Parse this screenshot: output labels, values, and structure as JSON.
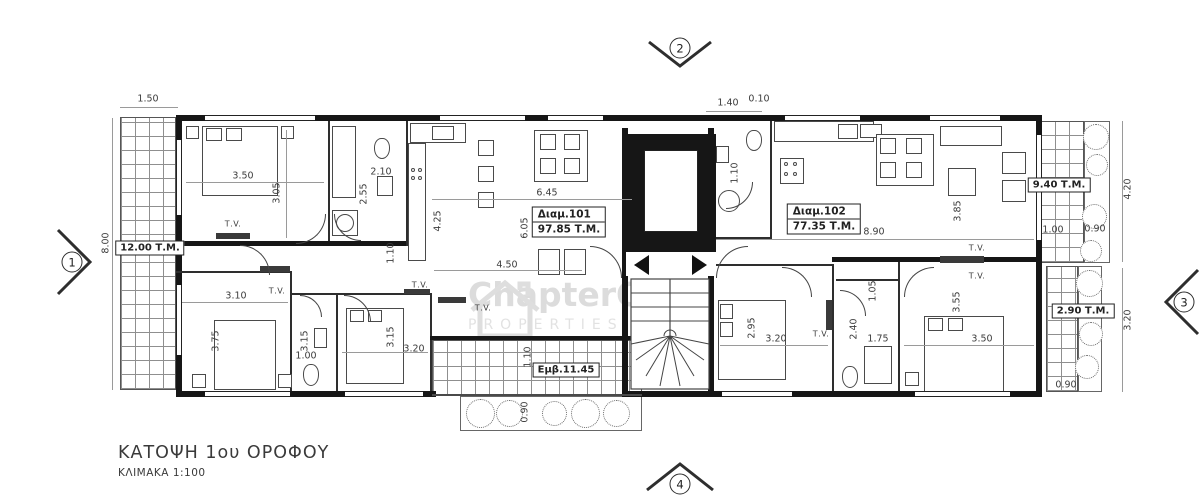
{
  "title": {
    "main": "ΚΑΤΟΨΗ 1ου ΟΡΟΦΟΥ",
    "scale": "ΚΛΙΜΑΚΑ 1:100"
  },
  "watermark": {
    "name": "ChapterONE",
    "tagline": "PROPERTIES"
  },
  "markers": {
    "m1": "1",
    "m2": "2",
    "m3": "3",
    "m4": "4"
  },
  "apartments": {
    "a101": {
      "label": "Διαμ.101",
      "area": "97.85 Τ.Μ."
    },
    "a102": {
      "label": "Διαμ.102",
      "area": "77.35 Τ.Μ."
    }
  },
  "areas": {
    "balcony_left": "12.00 Τ.Μ.",
    "balcony_right_top": "9.40 Τ.Μ.",
    "balcony_right_bottom": "2.90 Τ.Μ.",
    "balcony_bottom": "Εμβ.11.45"
  },
  "labels": {
    "tv": "Τ.V."
  },
  "dims": {
    "top_left_width": "1.50",
    "left_height": "8.00",
    "bed1_width": "3.50",
    "bed1_height": "3.05",
    "bath1_width": "2.10",
    "bath1_height": "2.55",
    "bath1_inner": "1.10",
    "kitchen_height": "4.25",
    "kitchen_width": "6.45",
    "living_height": "6.05",
    "living_width": "4.50",
    "bed2_width": "3.10",
    "bed2_height": "3.75",
    "wc_height": "3.15",
    "wc_width": "1.00",
    "bed3_height": "3.15",
    "bed3_width": "3.20",
    "balcony_bottom_depth": "1.10",
    "balcony_bottom_planter": "0.90",
    "top_entry": "1.40",
    "top_wall": "0.10",
    "bath2_width": "1.10",
    "apt102_width": "8.90",
    "living2_height": "3.85",
    "balcony_rt_width": "1.00",
    "balcony_rt_planter": "0.90",
    "balcony_rt_height": "4.20",
    "bed4_height": "2.95",
    "bed4_width": "3.20",
    "bath3_entry": "1.05",
    "bath3_height": "2.40",
    "bath3_width": "1.75",
    "bed5_height": "3.55",
    "bed5_width": "3.50",
    "balcony_rb_height": "3.20",
    "balcony_rb_planter": "0.90"
  }
}
